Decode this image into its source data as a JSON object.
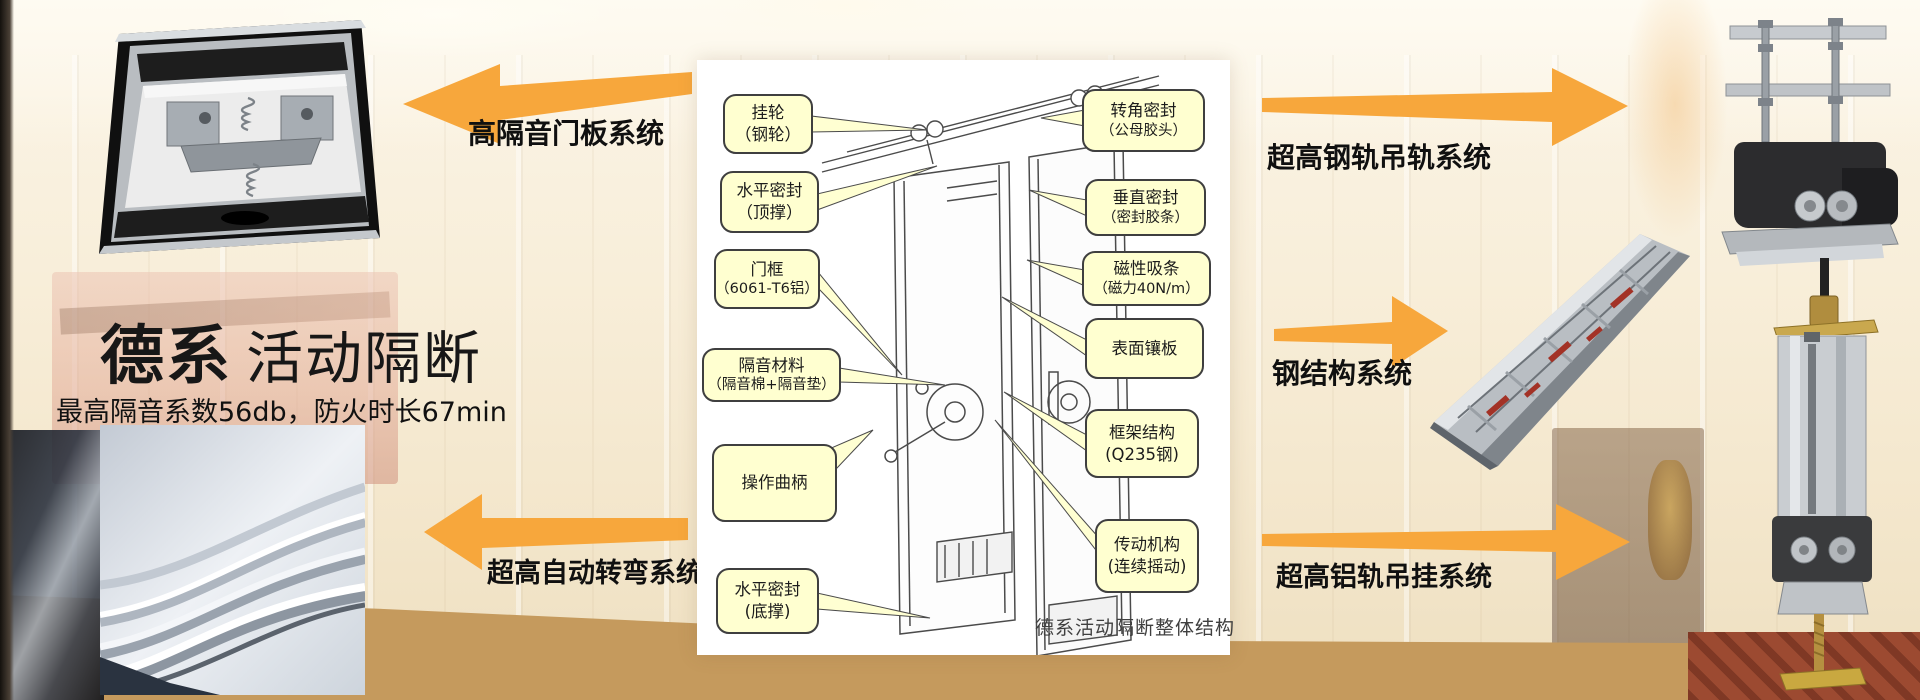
{
  "slide": {
    "title_strong": "德系",
    "title_light": "活动隔断",
    "subtitle": "最高隔音系数56db，防火时长67min"
  },
  "system_labels": {
    "door_panel": "高隔音门板系统",
    "auto_turn": "超高自动转弯系统",
    "steel_rail": "超高钢轨吊轨系统",
    "steel_structure": "钢结构系统",
    "alu_rail": "超高铝轨吊挂系统"
  },
  "diagram": {
    "caption": "德系活动隔断整体结构",
    "callouts_left": [
      {
        "line1": "挂轮",
        "line2": "（钢轮）"
      },
      {
        "line1": "水平密封",
        "line2": "（顶撑）"
      },
      {
        "line1": "门框",
        "line2": "（6061-T6铝）"
      },
      {
        "line1": "隔音材料",
        "line2": "（隔音棉+隔音垫）"
      },
      {
        "line1": "操作曲柄",
        "line2": ""
      },
      {
        "line1": "水平密封",
        "line2": "(底撑)"
      }
    ],
    "callouts_right": [
      {
        "line1": "转角密封",
        "line2": "（公母胶头）"
      },
      {
        "line1": "垂直密封",
        "line2": "（密封胶条）"
      },
      {
        "line1": "磁性吸条",
        "line2": "（磁力40N/m）"
      },
      {
        "line1": "表面镶板",
        "line2": ""
      },
      {
        "line1": "框架结构",
        "line2": "(Q235钢)"
      },
      {
        "line1": "传动机构",
        "line2": "(连续摇动)"
      }
    ]
  },
  "colors": {
    "arrow": "#F7A73C",
    "callout_bg": "#FFFFD0",
    "callout_border": "#3F3F3F",
    "label_text": "#101010"
  }
}
